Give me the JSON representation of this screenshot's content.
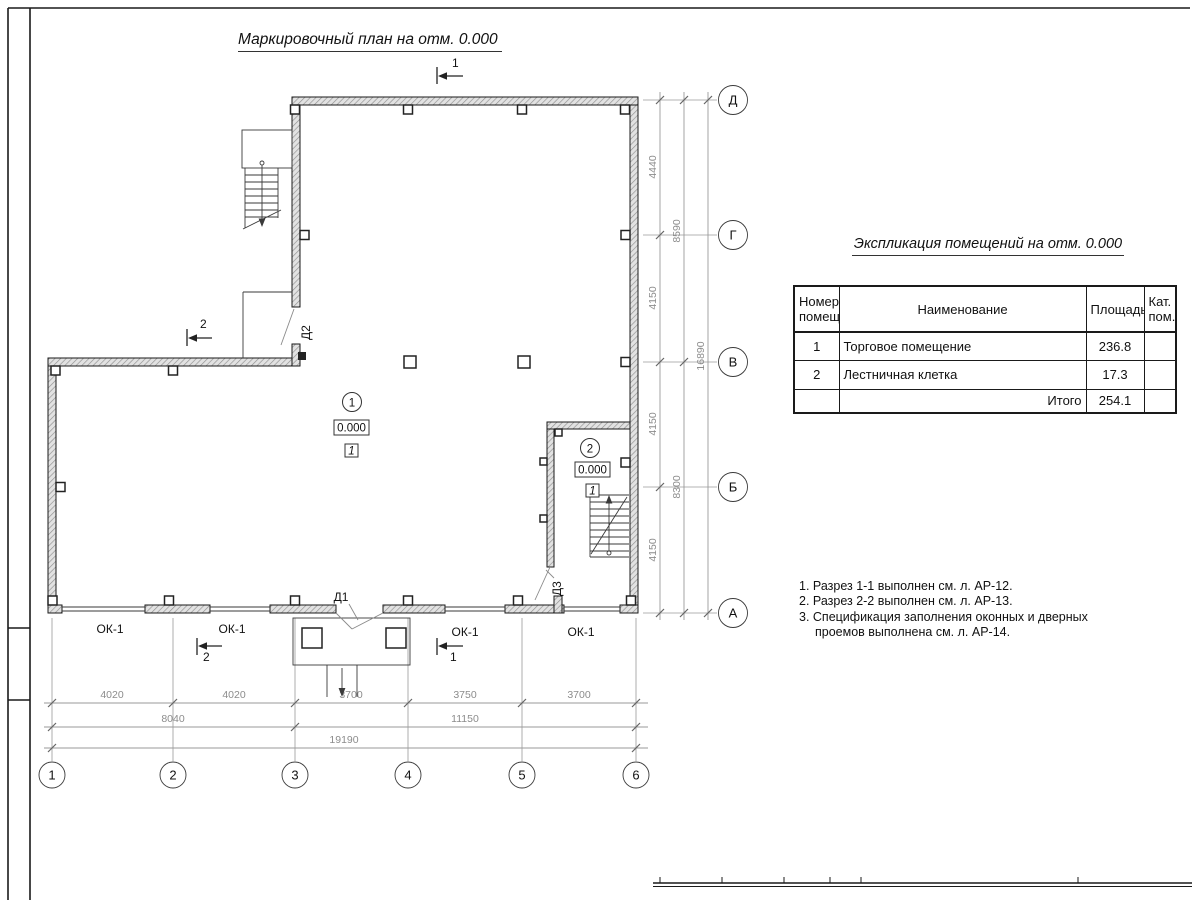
{
  "titles": {
    "plan": "Маркировочный план на отм. 0.000",
    "explication": "Экспликация помещений на отм. 0.000"
  },
  "explication_table": {
    "headers": {
      "num": "Номер\nпомещ.",
      "name": "Наименование",
      "area": "Площадь",
      "cat": "Кат.\nпом."
    },
    "rows": [
      {
        "num": "1",
        "name": "Торговое помещение",
        "area": "236.8",
        "cat": ""
      },
      {
        "num": "2",
        "name": "Лестничная клетка",
        "area": "17.3",
        "cat": ""
      }
    ],
    "total": {
      "label": "Итого",
      "area": "254.1",
      "cat": ""
    }
  },
  "notes": {
    "line1": "1. Разрез 1-1 выполнен см. л. АР-12.",
    "line2": "2. Разрез 2-2 выполнен см. л. АР-13.",
    "line3": "3. Спецификация заполнения оконных и дверных",
    "line4": "проемов выполнена см. л. АР-14."
  },
  "axes": {
    "rows": [
      "Д",
      "Г",
      "В",
      "Б",
      "А"
    ],
    "cols": [
      "1",
      "2",
      "3",
      "4",
      "5",
      "6"
    ]
  },
  "dimensions": {
    "right_c1": [
      "4440",
      "4150",
      "4150",
      "4150"
    ],
    "right_c2": [
      "8590",
      "8300"
    ],
    "right_total": "16890",
    "bottom_c1": [
      "4020",
      "4020",
      "3700",
      "3750",
      "3700"
    ],
    "bottom_c2": [
      "8040",
      "11150"
    ],
    "bottom_total": "19190"
  },
  "marks": {
    "window": "ОК-1",
    "door1": "Д1",
    "door2": "Д2",
    "door3": "Д3",
    "section1": "1",
    "section2": "2"
  },
  "rooms": {
    "room1": {
      "number": "1",
      "elevation": "0.000",
      "floor": "1"
    },
    "room2": {
      "number": "2",
      "elevation": "0.000",
      "floor": "1"
    }
  }
}
